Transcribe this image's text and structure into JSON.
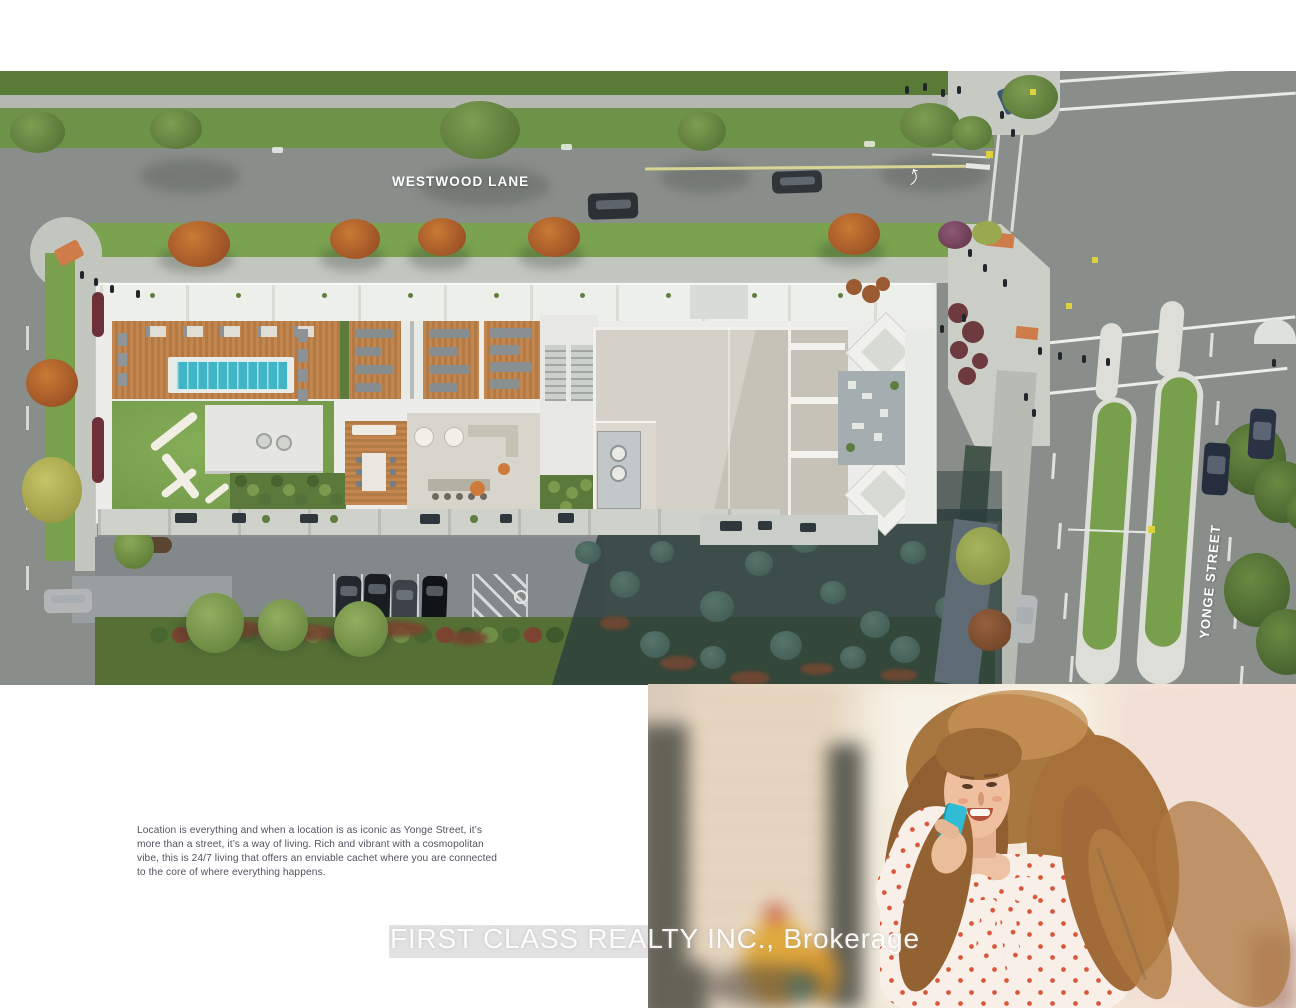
{
  "site_plan": {
    "street_labels": {
      "westwood": "WESTWOOD LANE",
      "yonge": "YONGE STREET"
    },
    "palette": {
      "road": "#8a8e8b",
      "top_grass": "#5a7a38",
      "boulevard_grass": "#7aa24f",
      "sidewalk": "#c3c6bf",
      "wood_deck": "#c2864e",
      "pool_water": "#3fb5c5",
      "roof_white": "#ecedea",
      "tower_roof_beige": "#cfcac0",
      "amenity_lawn": "#7aa14e",
      "autumn_tree": "#b25c2c",
      "building_shadow": "#2c3e3c",
      "median_grass": "#78a04c",
      "accent_orange_pad": "#ce7c49"
    }
  },
  "description": {
    "paragraph": "Location is everything and when a location is as iconic as Yonge Street, it’s more than a street, it’s a way of living. Rich and vibrant with a cosmopolitan vibe, this is 24/7 living that offers an enviable cachet where you are connected to the core of where everything happens."
  },
  "watermark": {
    "text": "FIRST CLASS REALTY INC., Brokerage"
  },
  "photo": {
    "subject": "woman talking on phone",
    "phone_color": "#35b9d0",
    "blouse_dot_color": "#d8573a"
  }
}
